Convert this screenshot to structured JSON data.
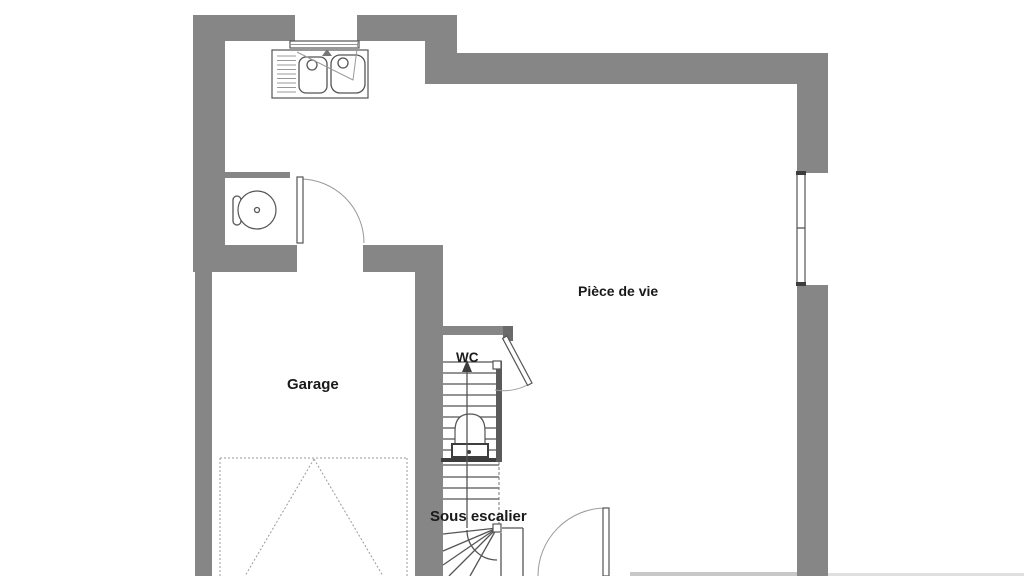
{
  "labels": {
    "garage": "Garage",
    "living_room": "Pièce de vie",
    "wc": "WC",
    "under_stairs": "Sous escalier"
  },
  "colors": {
    "wall": "#868686",
    "wall_dark": "#6a6a6a",
    "line": "#555555",
    "line_dark": "#3d3d3d",
    "line_light": "#999999",
    "text": "#1a1a1a",
    "background": "#ffffff"
  },
  "fixtures": [
    "kitchen-sink-icon",
    "kitchen-window-icon",
    "round-table-icon",
    "kitchen-door-icon",
    "garage-door-dashed-icon",
    "staircase-icon",
    "wc-door-icon",
    "toilet-icon",
    "right-window-icon",
    "entry-door-icon"
  ]
}
